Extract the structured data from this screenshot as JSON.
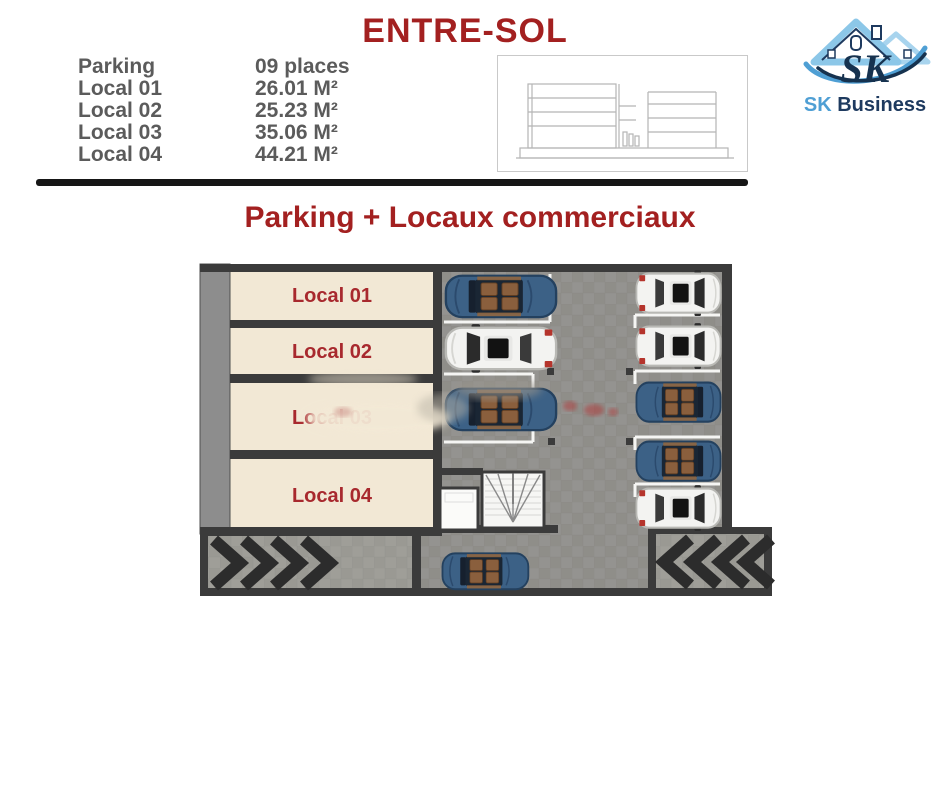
{
  "header": {
    "title": "ENTRE-SOL",
    "section_title": "Parking + Locaux commerciaux"
  },
  "legend": {
    "rows": [
      {
        "label": "Parking",
        "value": "09 places"
      },
      {
        "label": "Local 01",
        "value": "26.01 M²"
      },
      {
        "label": "Local 02",
        "value": "25.23 M²"
      },
      {
        "label": "Local 03",
        "value": "35.06 M²"
      },
      {
        "label": "Local 04",
        "value": "44.21 M²"
      }
    ]
  },
  "logo": {
    "monogram": "SK",
    "name_first": "SK",
    "name_rest": " Business"
  },
  "plan": {
    "rooms": [
      {
        "label": "Local 01"
      },
      {
        "label": "Local 02"
      },
      {
        "label": "Local 03"
      },
      {
        "label": "Local 04"
      }
    ],
    "parking_spaces": 9,
    "cars": {
      "blue_convertible": 5,
      "white": 4
    },
    "features": [
      "stairwell",
      "entry-ramp-left",
      "exit-ramp-right"
    ]
  },
  "colors": {
    "title_red": "#a32020",
    "room_label_red": "#a8292e",
    "legend_gray": "#5b5b5b",
    "room_beige": "#f2e8d5",
    "wall_dark": "#3b3b3b",
    "asphalt_gray": "#908f8a",
    "logo_light_blue": "#4f9fd4",
    "logo_navy": "#1e3a5f"
  }
}
